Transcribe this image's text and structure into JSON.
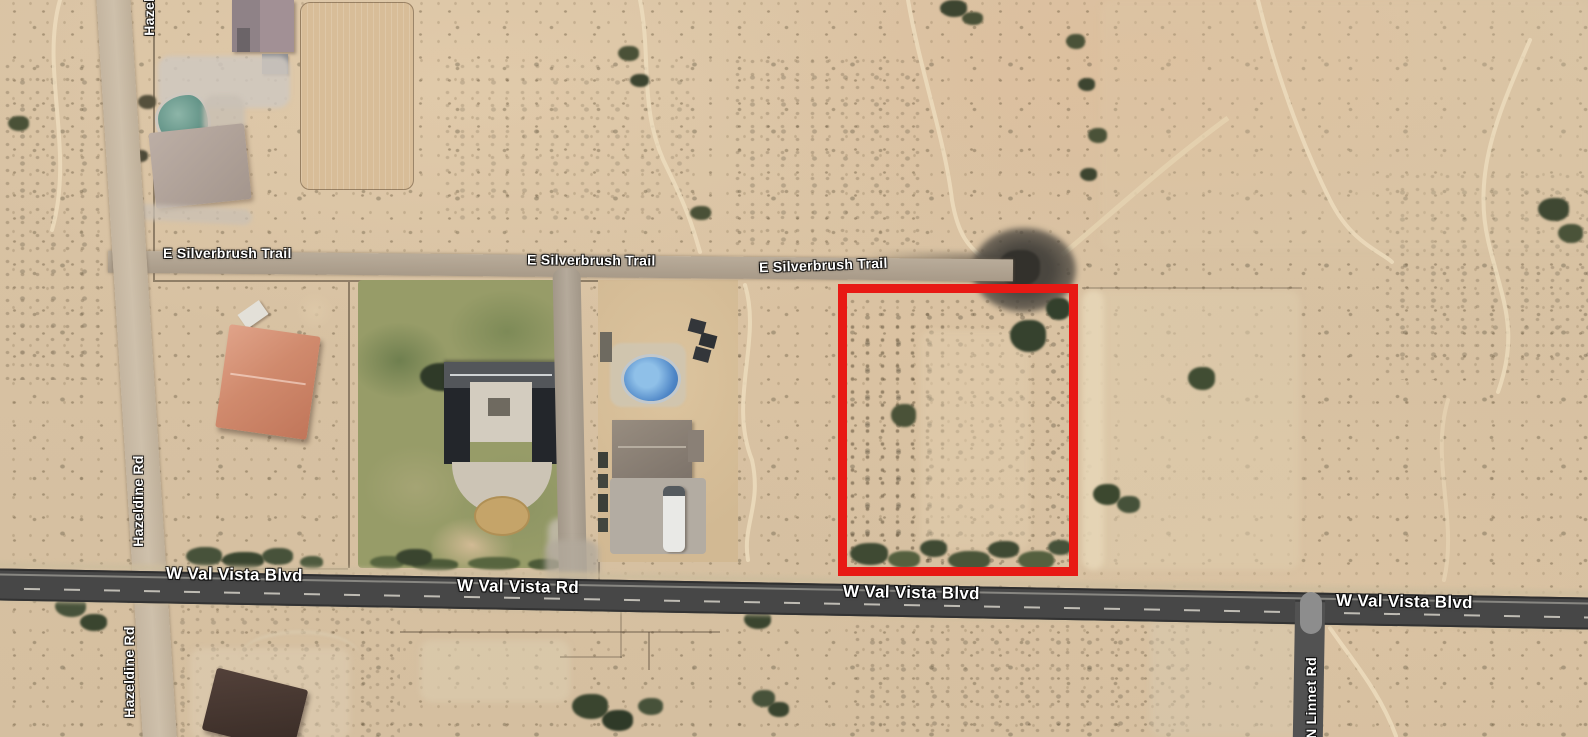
{
  "map": {
    "view_type": "satellite",
    "parcel_highlight": {
      "x": 838,
      "y": 284,
      "width": 240,
      "height": 292,
      "border_px": 9,
      "color": "#e81914"
    },
    "road_labels": [
      {
        "id": "silverbrush-1",
        "text": "E Silverbrush Trail",
        "x": 163,
        "y": 245,
        "size": 14,
        "rot": 0,
        "vertical": false
      },
      {
        "id": "silverbrush-2",
        "text": "E Silverbrush Trail",
        "x": 527,
        "y": 252,
        "size": 14,
        "rot": 0.5,
        "vertical": false
      },
      {
        "id": "silverbrush-3",
        "text": "E Silverbrush Trail",
        "x": 759,
        "y": 257,
        "size": 14,
        "rot": -2,
        "vertical": false
      },
      {
        "id": "valvista-1",
        "text": "W Val Vista Blvd",
        "x": 166,
        "y": 565,
        "size": 17,
        "rot": 1,
        "vertical": false
      },
      {
        "id": "valvista-2",
        "text": "W Val Vista Rd",
        "x": 457,
        "y": 577,
        "size": 17,
        "rot": 1,
        "vertical": false
      },
      {
        "id": "valvista-3",
        "text": "W Val Vista Blvd",
        "x": 843,
        "y": 583,
        "size": 17,
        "rot": 1,
        "vertical": false
      },
      {
        "id": "valvista-4",
        "text": "W Val Vista Blvd",
        "x": 1336,
        "y": 592,
        "size": 17,
        "rot": 1,
        "vertical": false
      },
      {
        "id": "hazeldine-top",
        "text": "Hazeldine Rd",
        "cx": 149,
        "cy": -10,
        "size": 14,
        "vertical": true
      },
      {
        "id": "hazeldine-middle",
        "text": "Hazeldine Rd",
        "cx": 138,
        "cy": 501,
        "size": 14,
        "vertical": true
      },
      {
        "id": "hazeldine-bottom",
        "text": "Hazeldine Rd",
        "cx": 129,
        "cy": 672,
        "size": 14,
        "vertical": true
      },
      {
        "id": "linnet",
        "text": "N Linnet Rd",
        "cx": 1311,
        "cy": 698,
        "size": 14,
        "vertical": true
      }
    ],
    "colors": {
      "desert_base": "#d9c3a4",
      "paved_road": "#474747",
      "dirt_road": "#b0a391",
      "parcel_outline": "#e81914",
      "lawn_green": "#8e9865",
      "pool_water": "#4d85c6"
    }
  }
}
